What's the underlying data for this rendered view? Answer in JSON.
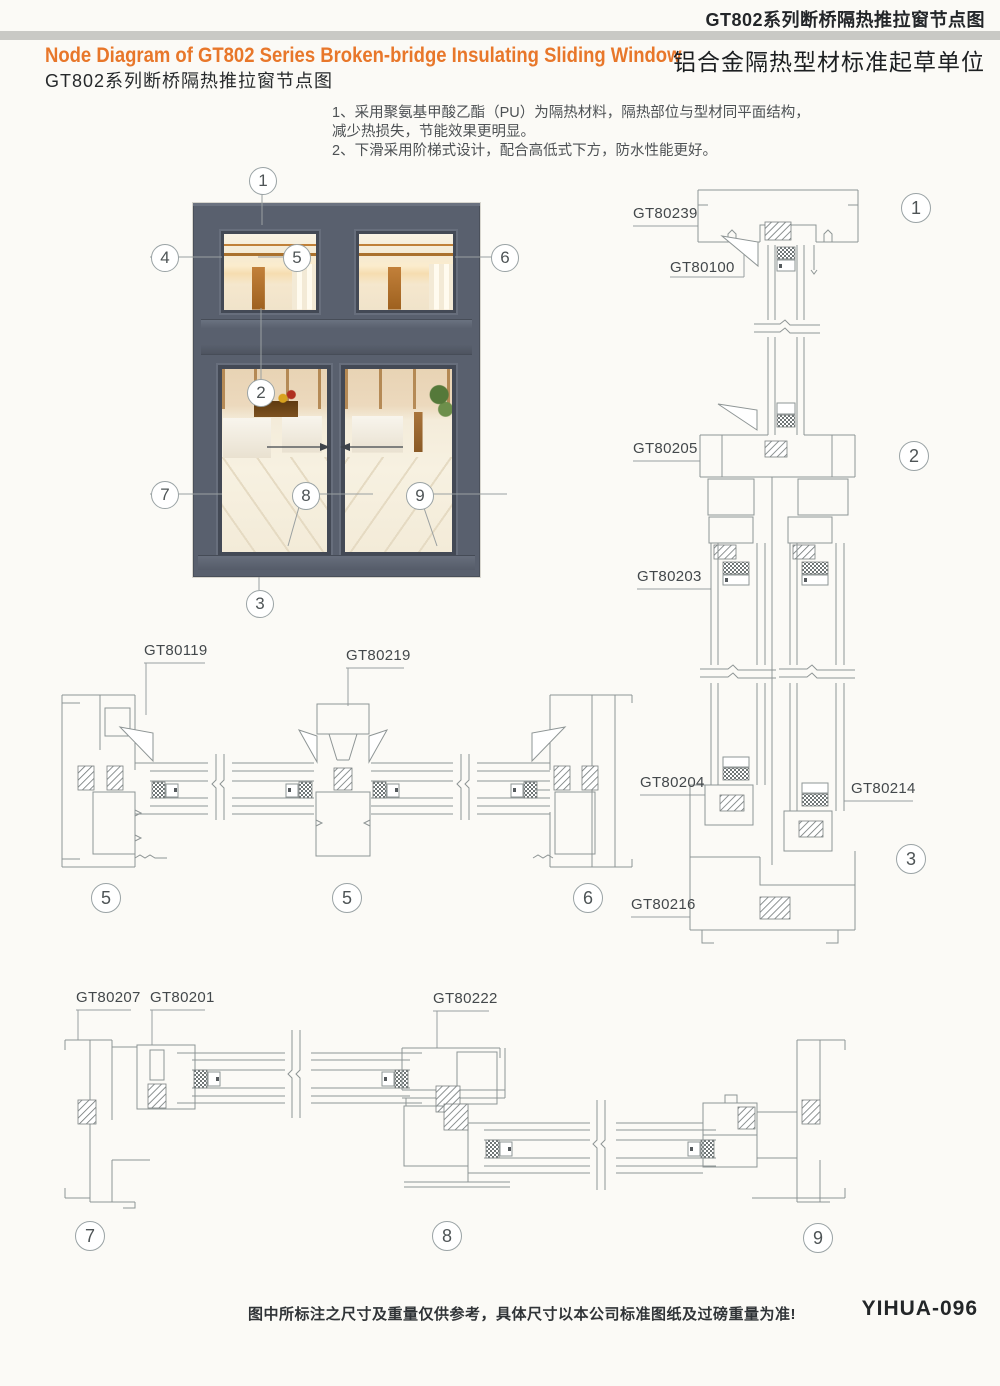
{
  "header": {
    "doc_title": "GT802系列断桥隔热推拉窗节点图",
    "title_en": "Node Diagram of GT802 Series Broken-bridge Insulating Sliding Window",
    "title_cn": "GT802系列断桥隔热推拉窗节点图",
    "org_subtitle": "铝合金隔热型材标准起草单位"
  },
  "notes": [
    "1、采用聚氨基甲酸乙酯（PU）为隔热材料，隔热部位与型材同平面结构，",
    "减少热损失，节能效果更明显。",
    "2、下滑采用阶梯式设计，配合高低式下方，防水性能更好。"
  ],
  "window_callouts": {
    "n1": "1",
    "n2": "2",
    "n3": "3",
    "n4": "4",
    "n5": "5",
    "n6": "6",
    "n7": "7",
    "n8": "8",
    "n9": "9"
  },
  "section_markers": {
    "s1": "1",
    "s2": "2",
    "s3": "3",
    "s5a": "5",
    "s5b": "5",
    "s6": "6",
    "s7": "7",
    "s8": "8",
    "s9": "9"
  },
  "profile_labels": {
    "l1": "GT80239",
    "l2": "GT80100",
    "l3": "GT80205",
    "l4": "GT80203",
    "l5": "GT80204",
    "l6": "GT80214",
    "l7": "GT80216",
    "l8": "GT80119",
    "l9": "GT80219",
    "l10": "GT80207",
    "l11": "GT80201",
    "l12": "GT80222"
  },
  "footer": {
    "disclaimer": "图中所标注之尺寸及重量仅供参考，具体尺寸以本公司标准图纸及过磅重量为准!",
    "page_code": "YIHUA-096"
  },
  "colors": {
    "accent_orange": "#e8772a",
    "frame_gray": "#59606e",
    "bar_gray": "#c9c9c5",
    "line_gray": "#8e9595"
  }
}
